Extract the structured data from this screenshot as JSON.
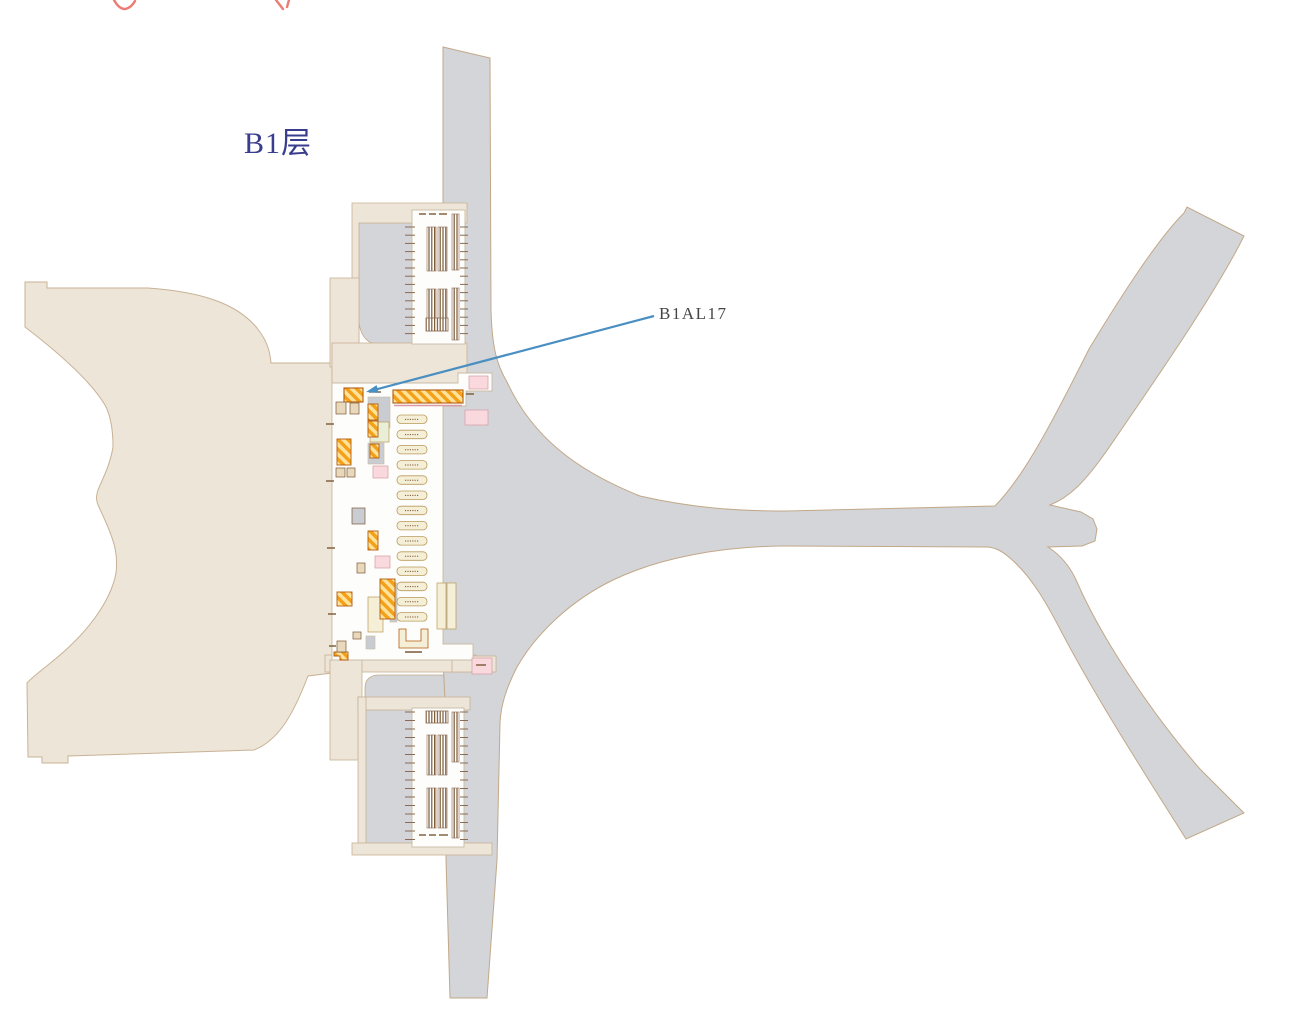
{
  "floor": {
    "label": "B1层"
  },
  "annotation": {
    "label": "B1AL17"
  },
  "colors": {
    "background": "#ffffff",
    "terminal": "#ece5d8",
    "terminal_border": "#c9b295",
    "road": "#d3d5d8",
    "road_border": "#c2a888",
    "white_area": "#fdfdfb",
    "white_border": "#c9bba6",
    "stall_orange": "#f5a118",
    "stall_yellow": "#ffe39a",
    "stall_border": "#b35b10",
    "pill_fill": "#f6efd8",
    "pill_border": "#b99a5b",
    "pink": "#f9d9de",
    "pink_border": "#d89aa4",
    "green": "#e9efd6",
    "inner_gray": "#c9ccd0",
    "micro_brown": "#7b5836",
    "tick": "#8a6a52",
    "floor_label": "#383d8e",
    "annot_label": "#454545",
    "arrow": "#4a8fc2",
    "cropped_red": "#ec7b74"
  },
  "map": {
    "regions": [
      {
        "name": "terminal-building"
      },
      {
        "name": "roadway-network"
      },
      {
        "name": "upper-parking-area"
      },
      {
        "name": "lower-parking-area"
      },
      {
        "name": "central-commercial-strip"
      },
      {
        "name": "highlighted-stall-B1AL17"
      }
    ],
    "counts": {
      "label_pills": 14,
      "upper_parking_ticks": 14,
      "lower_parking_ticks": 16
    }
  }
}
